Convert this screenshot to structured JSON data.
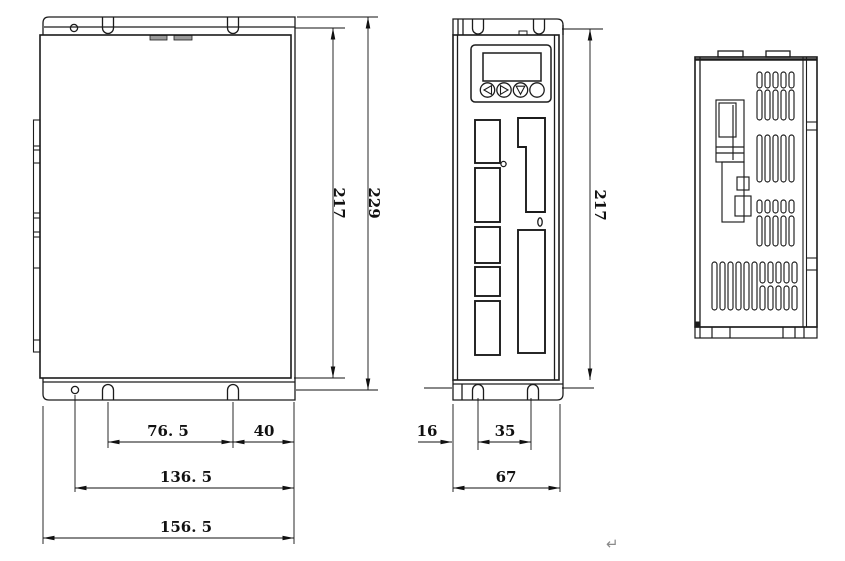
{
  "drawing": {
    "type": "technical-dimension-drawing",
    "view_count": 3
  },
  "dimensions": {
    "side": {
      "inner_height": "217",
      "outer_height": "229",
      "slot_spacing": "76. 5",
      "slot_to_edge": "40",
      "hole_to_edge": "136. 5",
      "overall_width": "156. 5"
    },
    "front": {
      "height": "217",
      "edge_to_slot": "16",
      "slot_spacing": "35",
      "overall_width": "67"
    }
  },
  "symbols": {
    "paragraph_mark": "↵"
  },
  "colors": {
    "line": "#1c1c1c",
    "tab_fill": "#9a9a9a",
    "paragraph_mark": "#8a8a8a"
  }
}
